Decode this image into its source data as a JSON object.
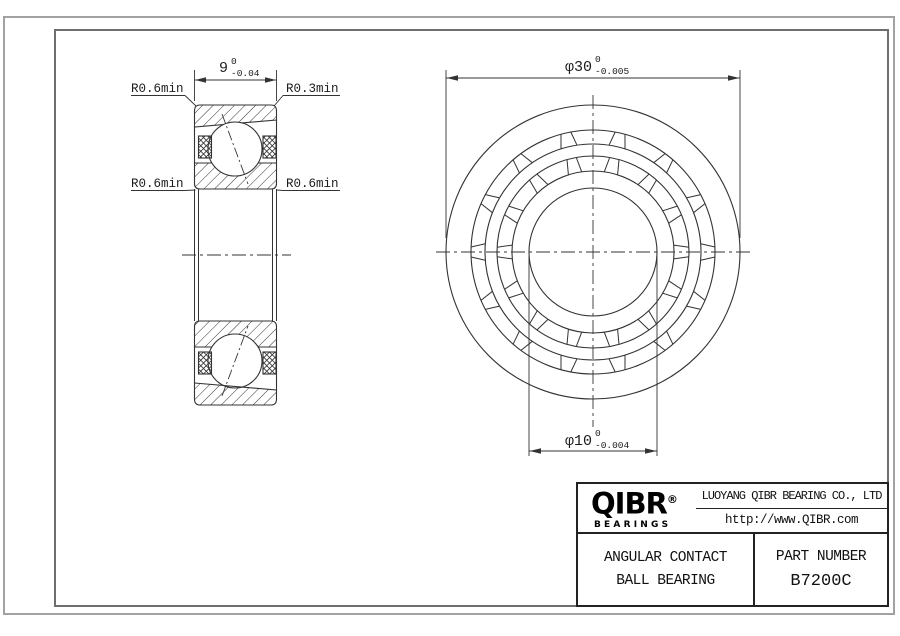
{
  "colors": {
    "background": "#ffffff",
    "line": "#333333",
    "text": "#111111",
    "inner_frame": "#6e6e6e",
    "sheet_border": "#a2a2a2",
    "title_block_border": "#222222"
  },
  "section_view": {
    "dim_width": {
      "value": "9",
      "tol_top": "0",
      "tol_bottom": "-0.04"
    },
    "labels": {
      "top_left": "R0.6min",
      "top_right": "R0.3min",
      "mid_left": "R0.6min",
      "mid_right": "R0.6min"
    }
  },
  "front_view": {
    "dim_outer": {
      "value": "φ30",
      "tol_top": "0",
      "tol_bottom": "-0.005"
    },
    "dim_bore": {
      "value": "φ10",
      "tol_top": "0",
      "tol_bottom": "-0.004"
    }
  },
  "title_block": {
    "logo": {
      "brand": "QIBR",
      "registered": "®",
      "sub": "BEARINGS"
    },
    "company": "LUOYANG QIBR BEARING CO., LTD",
    "website": "http://www.QIBR.com",
    "product_line1": "ANGULAR CONTACT",
    "product_line2": "BALL BEARING",
    "part_number_label": "PART NUMBER",
    "part_number": "B7200C"
  }
}
